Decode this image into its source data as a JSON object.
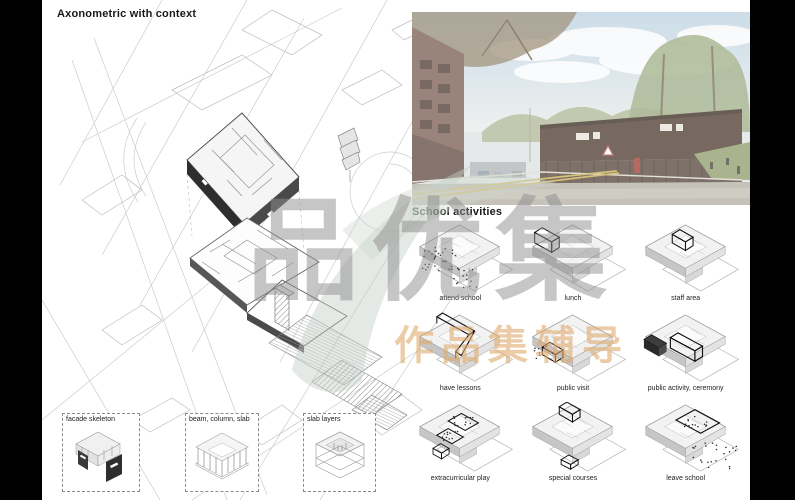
{
  "left_panel": {
    "title": "Axonometric with context",
    "legend_boxes": [
      {
        "label": "facade skeleton",
        "icon": "facade-skeleton-icon"
      },
      {
        "label": "beam, column, slab",
        "icon": "beam-column-slab-icon"
      },
      {
        "label": "slab layers",
        "icon": "slab-layers-icon"
      }
    ]
  },
  "right_panel": {
    "section_title": "School activities",
    "activities": [
      {
        "label": "attend school",
        "motif": "dots-entry"
      },
      {
        "label": "lunch",
        "motif": "box-top-left"
      },
      {
        "label": "staff area",
        "motif": "box-top-center"
      },
      {
        "label": "have lessons",
        "motif": "wing-right"
      },
      {
        "label": "public visit",
        "motif": "box-bottom-left"
      },
      {
        "label": "public activity, ceremony",
        "motif": "boxes-center-pair"
      },
      {
        "label": "extracurricular play",
        "motif": "courtyard-dots"
      },
      {
        "label": "special courses",
        "motif": "boxes-top-bottom"
      },
      {
        "label": "leave school",
        "motif": "area-top-right-dots"
      }
    ]
  },
  "watermark": {
    "main_text": "品优集",
    "sub_text": "作品集辅导",
    "main_color": "#8e8e8e",
    "sub_color": "#e0a96e"
  }
}
